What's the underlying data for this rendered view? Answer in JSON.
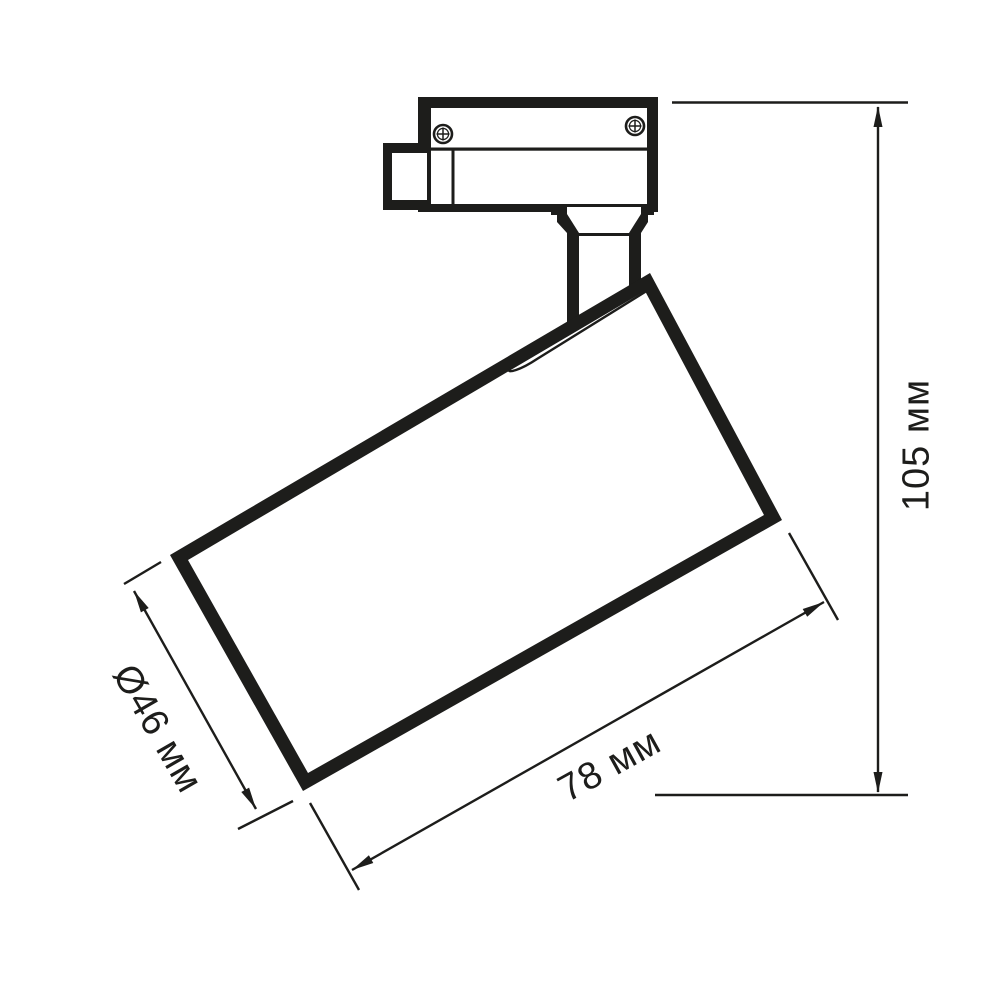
{
  "colors": {
    "ink": "#1d1d1b",
    "background": "#ffffff"
  },
  "dimensions": {
    "height": {
      "label": "105 мм"
    },
    "length": {
      "label": "78 мм"
    },
    "diameter": {
      "label": "Ø46 мм"
    }
  }
}
